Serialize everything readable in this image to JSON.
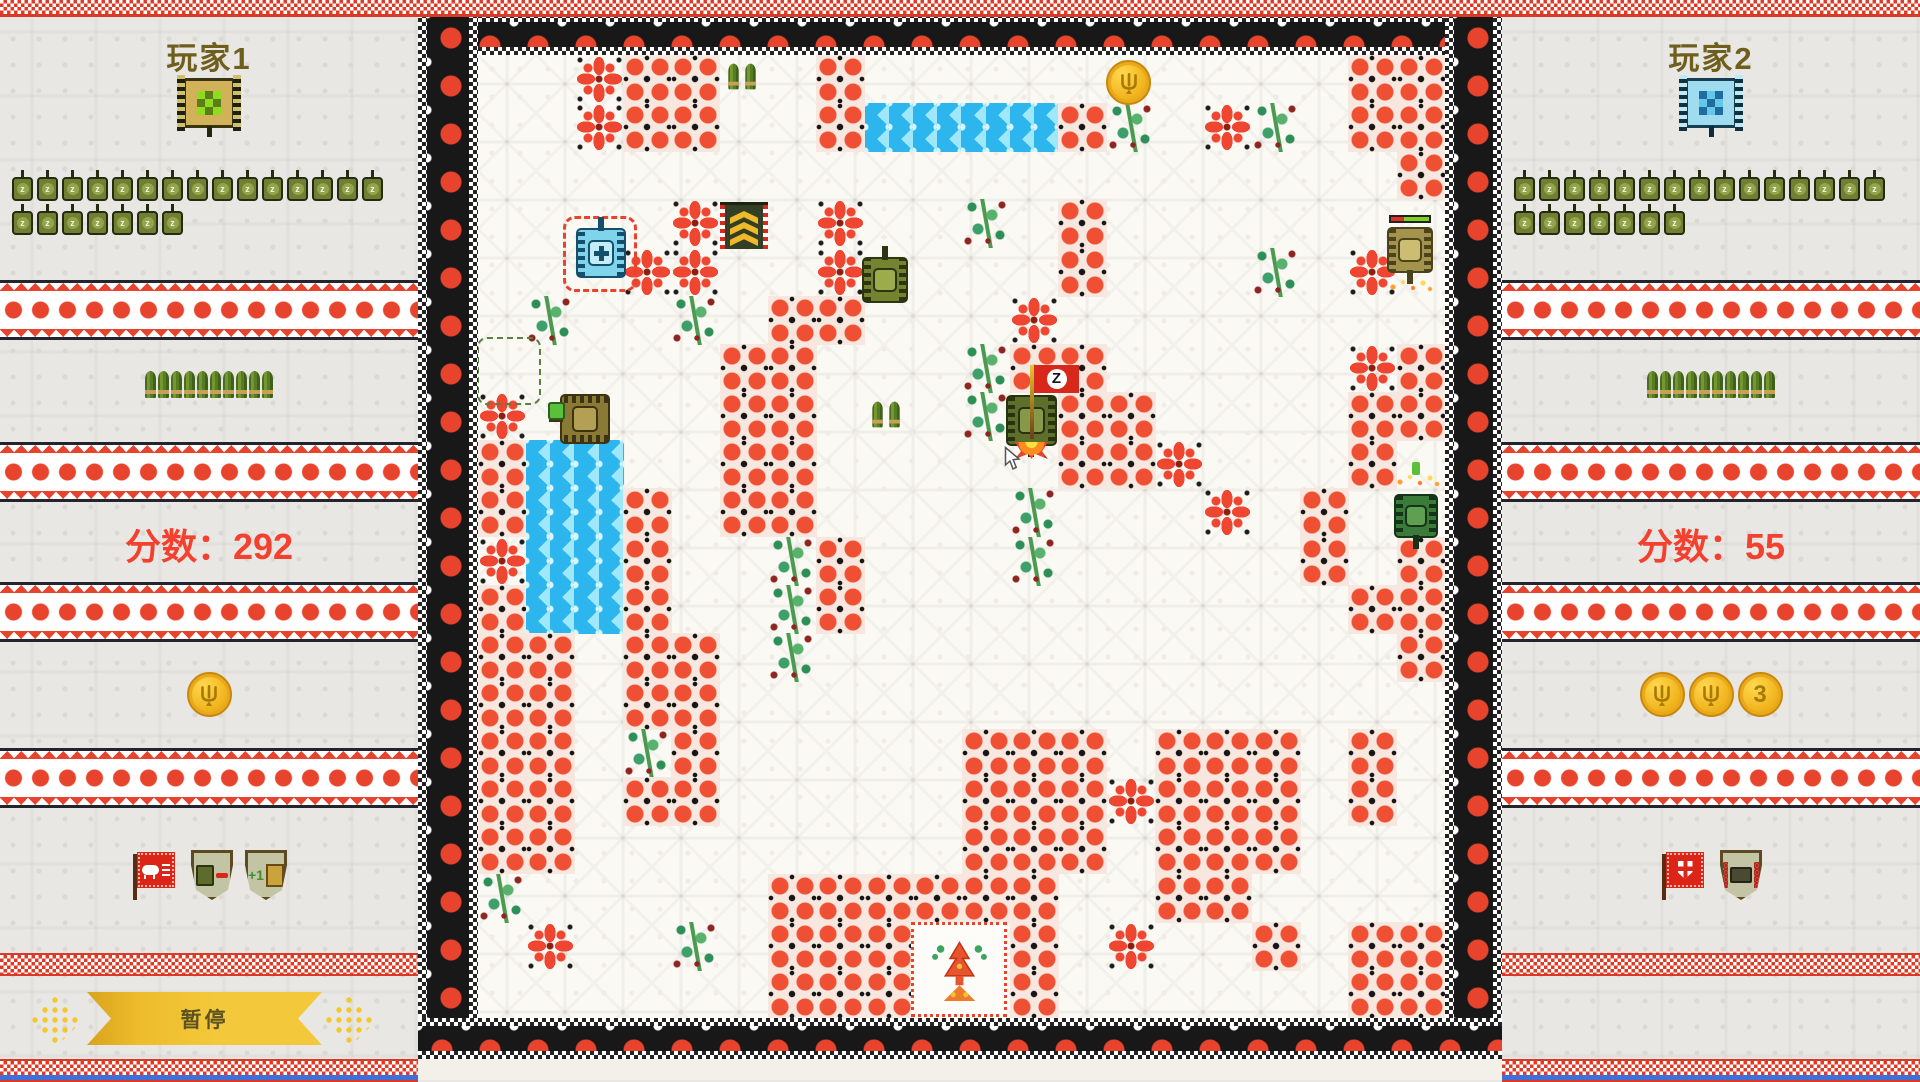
{
  "left_panel": {
    "title": "玩家1",
    "lives_row1": 15,
    "lives_row2": 7,
    "ammo_count": 10,
    "score_label": "分数：",
    "score_value": "292",
    "coins": [
      "trident"
    ],
    "powerups": [
      {
        "type": "red-flag",
        "emblem": "boar"
      },
      {
        "type": "shield",
        "emblem": "tank-and-bullet"
      },
      {
        "type": "shield",
        "emblem": "plus-one",
        "label": "+1"
      }
    ],
    "pause_label": "暂停"
  },
  "right_panel": {
    "title": "玩家2",
    "lives_row1": 15,
    "lives_row2": 7,
    "ammo_count": 10,
    "score_label": "分数：",
    "score_value": "55",
    "coins": [
      "trident",
      "trident",
      "3"
    ],
    "powerups": [
      {
        "type": "red-flag",
        "emblem": "shield-cross"
      },
      {
        "type": "shield",
        "emblem": "bullet-tank"
      }
    ]
  },
  "field": {
    "legend": {
      "B": "star-brick",
      "b": "flower-brick",
      "W": "water",
      "T": "bush",
      ".": "empty"
    },
    "map": [
      "..Bbb..b..........bb",
      "..Bbb..bWWWWbT.BT.bb",
      "...................b",
      "....B..B..T.b.......",
      "...BB..B....b...T.B.",
      ".T..T.bb...B........",
      ".....bb...Tbb.....Bb",
      "B....bb...T.bb....bb",
      "bWW..bb.....bbB...b.",
      "bWWb.bb....T...B.b..",
      "BWWb..Tb...T.....b.b",
      "bWWb..Tb..........bb",
      "bb.bb.T............b",
      "bb.bb...............",
      "bb.Tb.....bbb.bbb.b.",
      "bb.bb.....bbbBbbb.b.",
      "bb........bbb.bbb...",
      "T.....bbbbbb..bb....",
      ".B..T.bbb..b.B..b.bb",
      "......bbb..b......bb"
    ],
    "z_flag_label": "Z",
    "sergeant_chevrons": 3,
    "sprites": [
      {
        "kind": "vine",
        "name": "vine-outline",
        "x": 477,
        "y": 337,
        "w": 64,
        "h": 68
      },
      {
        "kind": "ring",
        "name": "spawn-ring",
        "x": 563,
        "y": 216,
        "w": 74,
        "h": 76
      },
      {
        "kind": "tank",
        "name": "player2-tank",
        "x": 576,
        "y": 228,
        "s": 50,
        "dir": "up",
        "body": "#7fd4ec",
        "dark": "#14506b",
        "lt": "#c2ecf7",
        "glyph": true
      },
      {
        "kind": "banner",
        "name": "sergeant-stripes-pickup",
        "x": 720,
        "y": 202
      },
      {
        "kind": "ammo",
        "name": "ammo-pickup",
        "x": 727,
        "y": 63
      },
      {
        "kind": "tank",
        "name": "enemy-tank",
        "x": 862,
        "y": 257,
        "s": 46,
        "dir": "up",
        "body": "#74832f",
        "dark": "#2c350f",
        "lt": "#9cab4b"
      },
      {
        "kind": "tank",
        "name": "enemy-tank-left",
        "x": 560,
        "y": 394,
        "s": 50,
        "dir": "left",
        "body": "#8a7a35",
        "dark": "#3c3312",
        "lt": "#b3a055",
        "rider": true
      },
      {
        "kind": "ammo",
        "name": "ammo-pickup",
        "x": 871,
        "y": 401
      },
      {
        "kind": "coin",
        "name": "coin-pickup",
        "x": 1106,
        "y": 60
      },
      {
        "kind": "tank",
        "name": "z-flag-tank",
        "x": 1006,
        "y": 395,
        "s": 51,
        "dir": "down",
        "body": "#5e6e2b",
        "dark": "#27330e",
        "lt": "#87984a",
        "zflag": true,
        "flame": true
      },
      {
        "kind": "tank",
        "name": "bonus-tank",
        "x": 1387,
        "y": 227,
        "s": 46,
        "dir": "down",
        "body": "#a4934d",
        "dark": "#4a431c",
        "lt": "#cdbd72",
        "hbar": true,
        "sparks": "below"
      },
      {
        "kind": "tank",
        "name": "green-tank",
        "x": 1394,
        "y": 494,
        "s": 44,
        "dir": "down",
        "body": "#3c7a3a",
        "dark": "#14341a",
        "lt": "#5ea04f",
        "sparks": "above"
      },
      {
        "kind": "cursor",
        "name": "mouse-cursor",
        "x": 1004,
        "y": 446
      }
    ],
    "base": {
      "name": "base-tree-of-life",
      "x": 911,
      "y": 922,
      "w": 96,
      "h": 95
    }
  },
  "colors": {
    "accent_red": "#e8432c",
    "score_red": "#f4402e",
    "title_olive": "#6f5f1f",
    "gold": "#f3c83a",
    "water_blue": "#2db5ee",
    "bush_green": "#3da06a",
    "border_black": "#181818",
    "bottom_blue": "#3f6fd8"
  }
}
